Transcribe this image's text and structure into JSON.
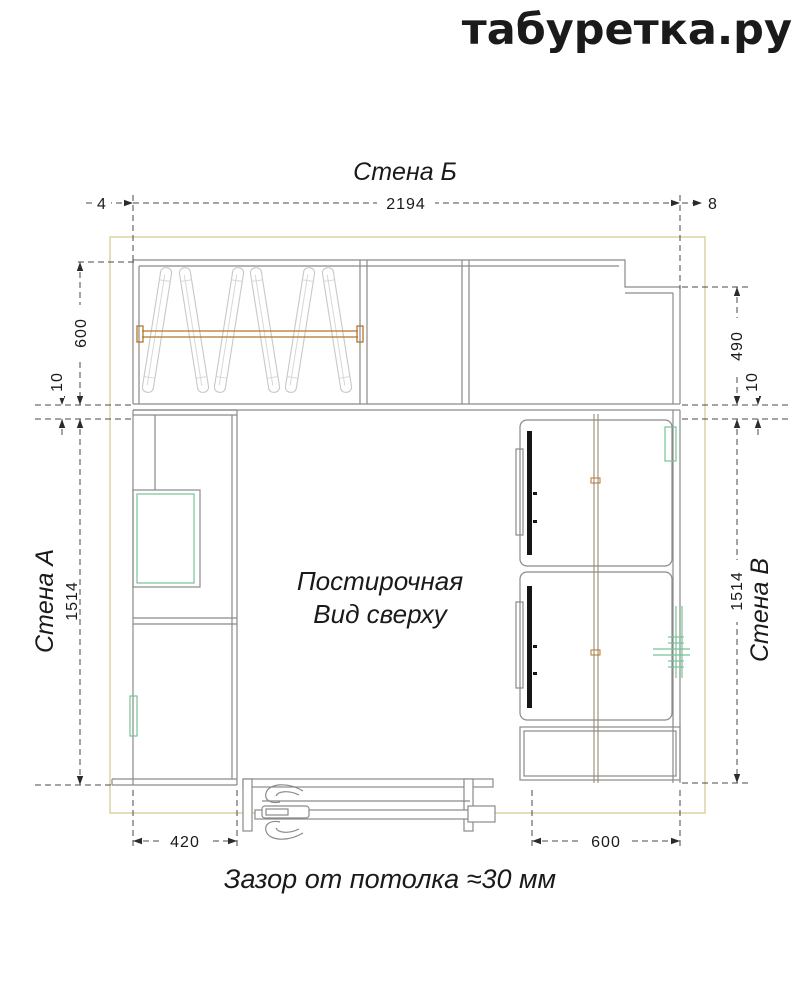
{
  "brand": {
    "logo_text": "табуретка.ру"
  },
  "walls": {
    "top_label": "Стена Б",
    "left_label": "Стена А",
    "right_label": "Стена В"
  },
  "title": {
    "room": "Постирочная",
    "view": "Вид сверху"
  },
  "note": {
    "ceiling_gap": "Зазор от потолка ≈30 мм"
  },
  "dims": {
    "gap_left_top": "4",
    "width_top": "2194",
    "gap_right_top": "8",
    "depth_left": "600",
    "gap_left": "10",
    "height_left": "1514",
    "depth_right": "490",
    "gap_right": "10",
    "height_right": "1514",
    "width_bottom_left": "420",
    "width_bottom_right": "600"
  },
  "colors": {
    "room_outline": "#d8d09c",
    "cabinet_line": "#8a8a8a",
    "rod": "#b5752c",
    "fittings_green": "#74c394",
    "dimension_line": "#4a4a4a",
    "text": "#1a1a1a"
  }
}
